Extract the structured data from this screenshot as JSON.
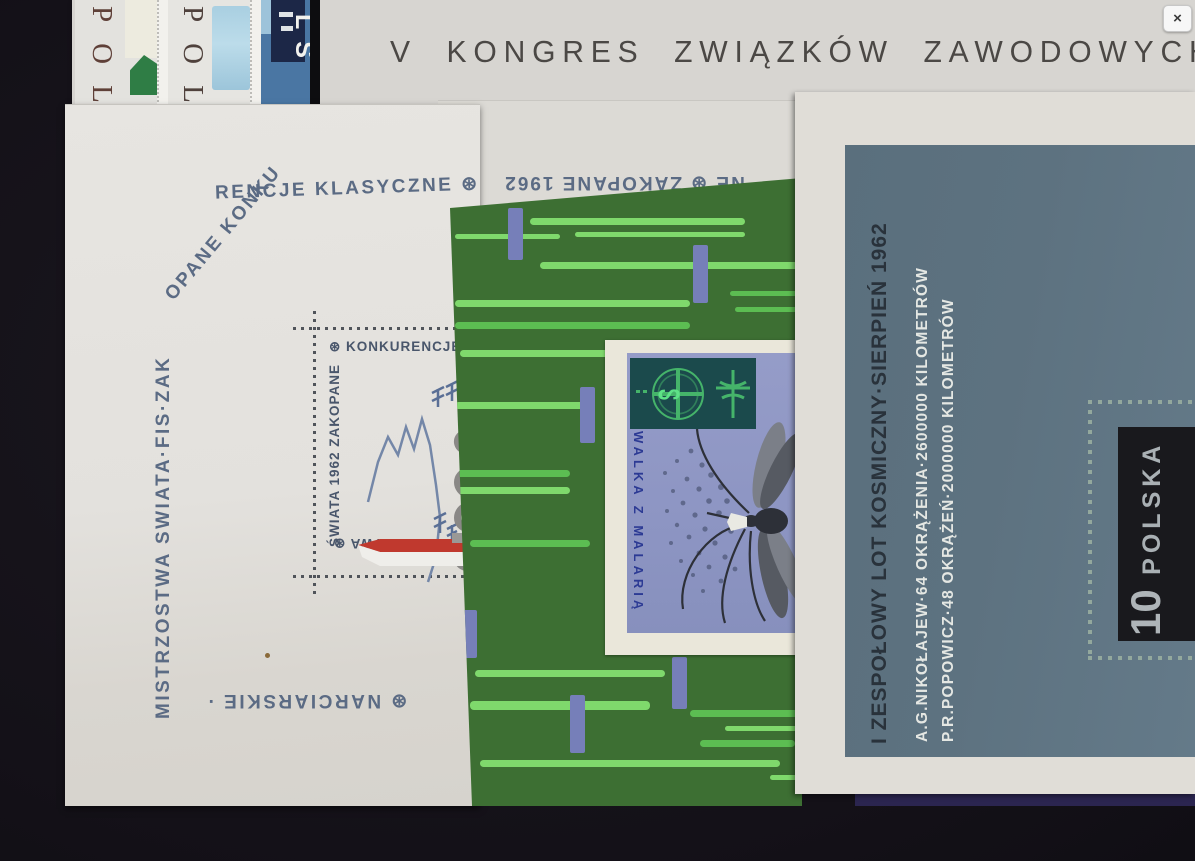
{
  "overlay": {
    "close_label": "×"
  },
  "kongres_sheet": {
    "title": "V KONGRES ZWIĄZKÓW ZAWODOWYCH",
    "paper_color": "#d7d5d1",
    "text_color": "#4b4845"
  },
  "stamp_strip": {
    "stamp1": {
      "country_fragment": "POL"
    },
    "stamp2": {
      "country_fragment": "POL"
    },
    "stamp3": {
      "country_fragment": "LS"
    }
  },
  "zakopane_sheet": {
    "border_left": "MISTRZOSTWA SWIATA·FIS·ZAK",
    "border_curve": "OPANE KONKU",
    "border_top": "RENCJE KLASYCZNE ⊛",
    "border_bottom": "⊛ NARCIARSKIE ·",
    "inner_top": "⊛ KONKURENCJE K",
    "inner_left": "ŚWIATA 1962 ZAKOPANE",
    "inner_bottom": "E MISTRZOSTWA ⊛",
    "text_color": "#5b6b84",
    "ski_red": "#c0392e"
  },
  "flipped_sheet": {
    "border_fragment": "NE ⊛ ZAKOPANE 1962"
  },
  "malaria_sheet": {
    "stamp_text": "WALKA Z MALARIĄ",
    "snake_glyph": "ᔕ",
    "sheet_green": "#3d6f33",
    "streak_green": "#7fd96c",
    "bar_blue": "#767fb9",
    "stamp_blue": "#8d95c3",
    "emblem_teal": "#1b4a4c"
  },
  "space_sheet": {
    "line1": "I ZESPOŁOWY LOT KOSMICZNY·SIERPIEŃ 1962",
    "line2": "A.G.NIKOŁAJEW·64 OKRĄŻENIA·2600000 KILOMETRÓW",
    "line3": "P.R.POPOWICZ·48 OKRĄŻEŃ·2000000 KILOMETRÓW",
    "stamp_value": "10",
    "stamp_country": "POLSKA",
    "slate_color": "#5d7280",
    "stamp_dark": "#19191d"
  }
}
